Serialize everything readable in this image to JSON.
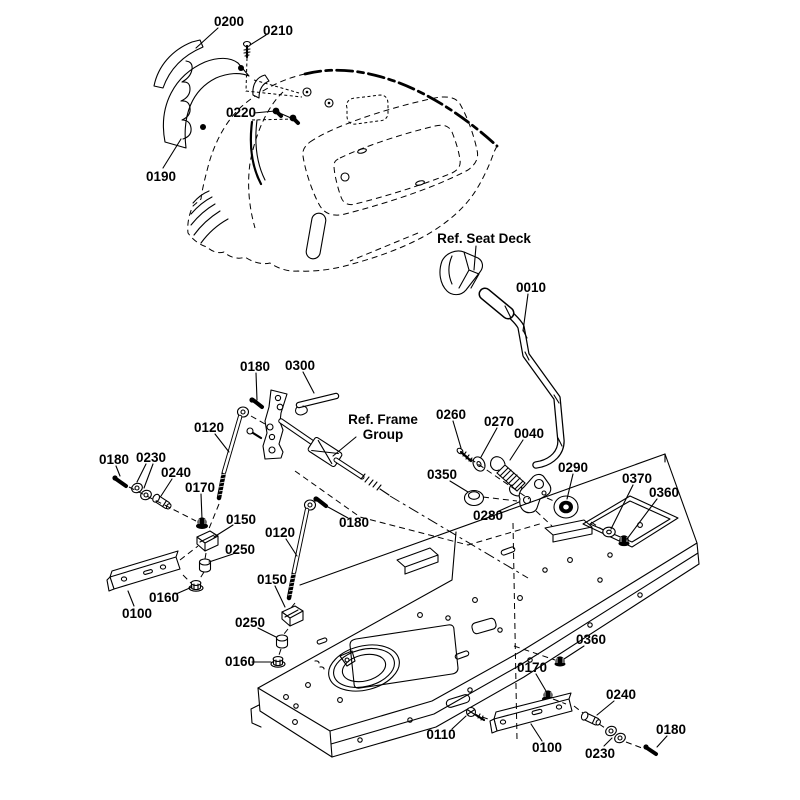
{
  "diagram": {
    "kind": "exploded-parts-diagram",
    "background_color": "#ffffff",
    "line_color": "#000000",
    "callouts": [
      {
        "id": "c0",
        "text": "0200"
      },
      {
        "id": "c1",
        "text": "0210"
      },
      {
        "id": "c2",
        "text": "0220"
      },
      {
        "id": "c3",
        "text": "0190"
      },
      {
        "id": "c4",
        "text": "Ref. Seat Deck"
      },
      {
        "id": "c5",
        "text": "0010"
      },
      {
        "id": "c6",
        "text": "0180"
      },
      {
        "id": "c7",
        "text": "0300"
      },
      {
        "id": "c8",
        "text": "Ref. Frame"
      },
      {
        "id": "c9",
        "text": "Group"
      },
      {
        "id": "c10",
        "text": "0260"
      },
      {
        "id": "c11",
        "text": "0270"
      },
      {
        "id": "c12",
        "text": "0040"
      },
      {
        "id": "c13",
        "text": "0120"
      },
      {
        "id": "c14",
        "text": "0180"
      },
      {
        "id": "c15",
        "text": "0230"
      },
      {
        "id": "c16",
        "text": "0240"
      },
      {
        "id": "c17",
        "text": "0170"
      },
      {
        "id": "c18",
        "text": "0350"
      },
      {
        "id": "c19",
        "text": "0290"
      },
      {
        "id": "c20",
        "text": "0370"
      },
      {
        "id": "c21",
        "text": "0360"
      },
      {
        "id": "c22",
        "text": "0280"
      },
      {
        "id": "c23",
        "text": "0150"
      },
      {
        "id": "c24",
        "text": "0120"
      },
      {
        "id": "c25",
        "text": "0180"
      },
      {
        "id": "c26",
        "text": "0250"
      },
      {
        "id": "c27",
        "text": "0160"
      },
      {
        "id": "c28",
        "text": "0100"
      },
      {
        "id": "c29",
        "text": "0150"
      },
      {
        "id": "c30",
        "text": "0250"
      },
      {
        "id": "c31",
        "text": "0160"
      },
      {
        "id": "c32",
        "text": "0360"
      },
      {
        "id": "c33",
        "text": "0170"
      },
      {
        "id": "c34",
        "text": "0240"
      },
      {
        "id": "c35",
        "text": "0110"
      },
      {
        "id": "c36",
        "text": "0100"
      },
      {
        "id": "c37",
        "text": "0230"
      },
      {
        "id": "c38",
        "text": "0180"
      }
    ]
  }
}
